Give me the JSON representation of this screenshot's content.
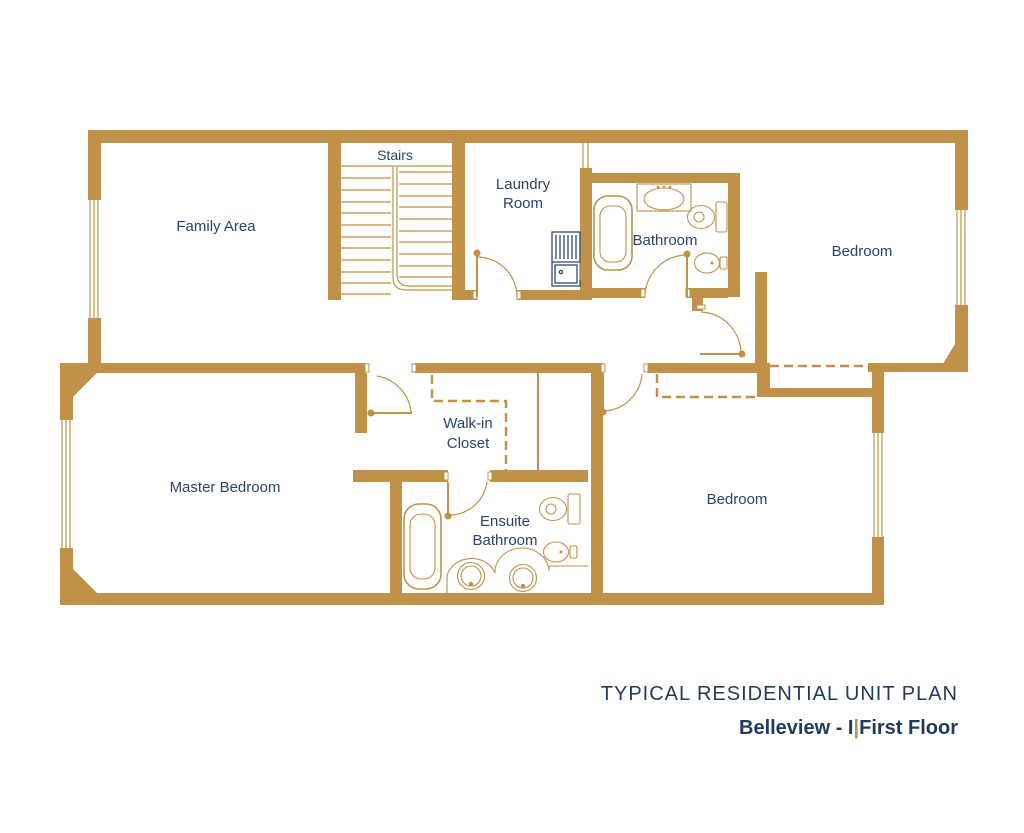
{
  "title": {
    "line1": "TYPICAL RESIDENTIAL UNIT PLAN",
    "brand": "Belleview - I",
    "separator": "|",
    "floor": "First Floor"
  },
  "rooms": {
    "family_area": {
      "label": "Family Area"
    },
    "stairs": {
      "label": "Stairs"
    },
    "laundry": {
      "line1": "Laundry",
      "line2": "Room"
    },
    "bathroom": {
      "label": "Bathroom"
    },
    "bedroom_top": {
      "label": "Bedroom"
    },
    "master_bedroom": {
      "label": "Master Bedroom"
    },
    "walkin_closet": {
      "line1": "Walk-in",
      "line2": "Closet"
    },
    "ensuite": {
      "line1": "Ensuite",
      "line2": "Bathroom"
    },
    "bedroom_bottom": {
      "label": "Bedroom"
    }
  },
  "colors": {
    "wall": "#C09148",
    "label": "#29436B",
    "title": "#1E3A5E",
    "appliance": "#2B4A76",
    "background": "#FFFFFF"
  }
}
